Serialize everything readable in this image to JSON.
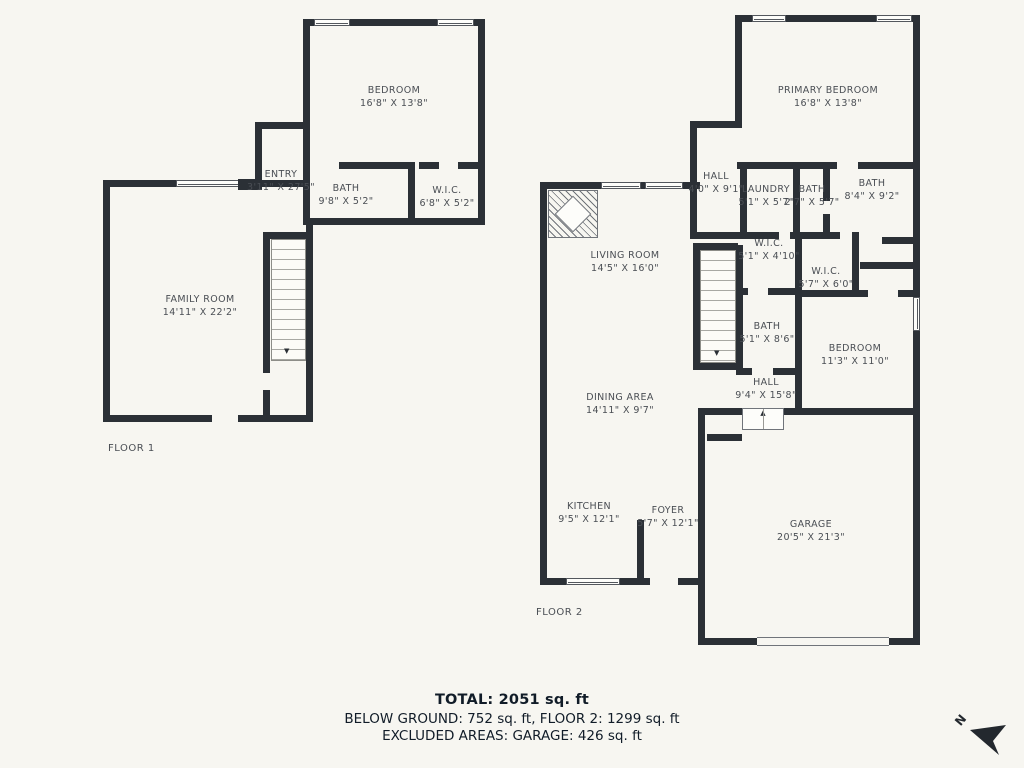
{
  "floors": [
    {
      "label": "FLOOR 1",
      "rooms": [
        {
          "name": "BEDROOM",
          "dims": "16'8\" X 13'8\""
        },
        {
          "name": "ENTRY",
          "dims": "3'11\" X 27'5\""
        },
        {
          "name": "BATH",
          "dims": "9'8\" X 5'2\""
        },
        {
          "name": "W.I.C.",
          "dims": "6'8\" X 5'2\""
        },
        {
          "name": "FAMILY ROOM",
          "dims": "14'11\" X 22'2\""
        }
      ]
    },
    {
      "label": "FLOOR 2",
      "rooms": [
        {
          "name": "PRIMARY BEDROOM",
          "dims": "16'8\" X 13'8\""
        },
        {
          "name": "HALL",
          "dims": "4'0\" X 9'1\""
        },
        {
          "name": "LAUNDRY",
          "dims": "5'1\" X 5'7\""
        },
        {
          "name": "BATH",
          "dims": "2'7\" X 5'7\""
        },
        {
          "name": "BATH",
          "dims": "8'4\" X 9'2\""
        },
        {
          "name": "W.I.C.",
          "dims": "5'1\" X 4'10\""
        },
        {
          "name": "W.I.C.",
          "dims": "5'7\" X 6'0\""
        },
        {
          "name": "LIVING ROOM",
          "dims": "14'5\" X 16'0\""
        },
        {
          "name": "BATH",
          "dims": "5'1\" X 8'6\""
        },
        {
          "name": "BEDROOM",
          "dims": "11'3\" X 11'0\""
        },
        {
          "name": "HALL",
          "dims": "9'4\" X 15'8\""
        },
        {
          "name": "DINING AREA",
          "dims": "14'11\" X 9'7\""
        },
        {
          "name": "KITCHEN",
          "dims": "9'5\" X 12'1\""
        },
        {
          "name": "FOYER",
          "dims": "5'7\" X 12'1\""
        },
        {
          "name": "GARAGE",
          "dims": "20'5\" X 21'3\""
        }
      ]
    }
  ],
  "summary": {
    "total": "TOTAL: 2051 sq. ft",
    "line2": "BELOW GROUND: 752 sq. ft, FLOOR 2: 1299 sq. ft",
    "line3": "EXCLUDED AREAS: GARAGE: 426 sq. ft"
  },
  "compass": {
    "label": "N"
  },
  "icons": {
    "stairs_down": "▼",
    "step_up": "▲"
  },
  "colors": {
    "background": "#f7f6f1",
    "wall": "#2b3036",
    "label_text": "#4a4e54",
    "summary_text": "#111c28"
  }
}
